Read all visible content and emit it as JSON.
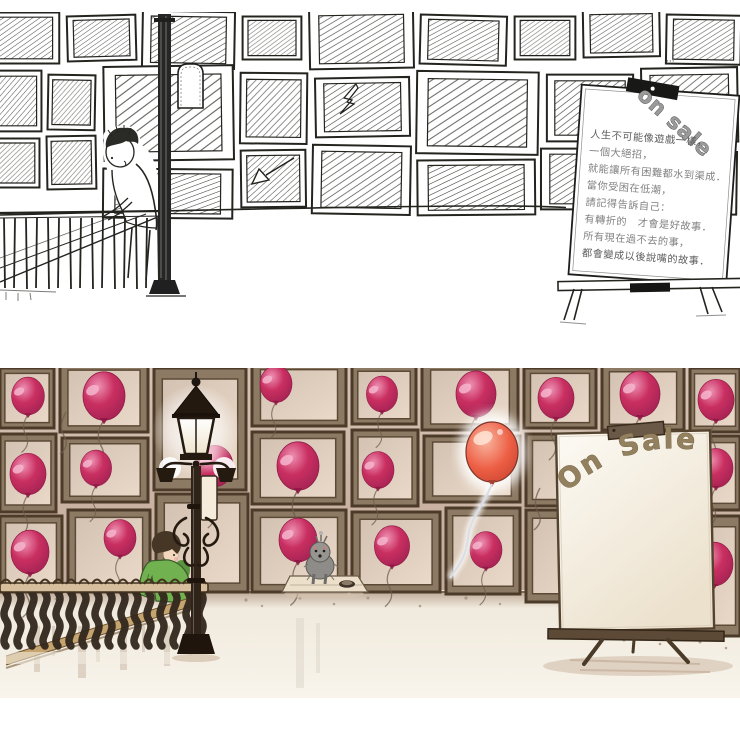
{
  "artwork": {
    "title": "balloon gallery illustration — ink draft and watercolor final",
    "panels": {
      "sketch": {
        "label": "ink draft",
        "sign_board": {
          "corner_label": "on sale",
          "lines": [
            "人生不可能像遊戲一樣，",
            "一個大絕招，",
            "就能讓所有困難都水到渠成．",
            "當你受困在低潮，",
            "請記得告訴自己：",
            "有轉折的　才會是好故事．",
            "所有現在過不去的事，",
            "都會變成以後說嘴的故事．"
          ]
        }
      },
      "color": {
        "label": "watercolor final",
        "sign_board": {
          "label": "On Sale"
        }
      }
    },
    "palette": {
      "ink": "#24241f",
      "paper": "#ffffff",
      "wall": "#c6afa0",
      "wall_light": "#d6c3b4",
      "frame_face": "#8d7a64",
      "frame_border": "#4d3b29",
      "balloon": "#c9295e",
      "balloon_highlight": "#f0a0bf",
      "escaped_balloon": "#ed5f45",
      "jacket_green": "#72b14f",
      "skin": "#f2d7bf",
      "hair": "#463626",
      "iron": "#261c12",
      "rail_wood": "#d7bf9e",
      "ground": "#f4eee3",
      "dog_gray": "#94928d",
      "sign_text": "#93805e",
      "string": "#6d5c4e"
    }
  }
}
